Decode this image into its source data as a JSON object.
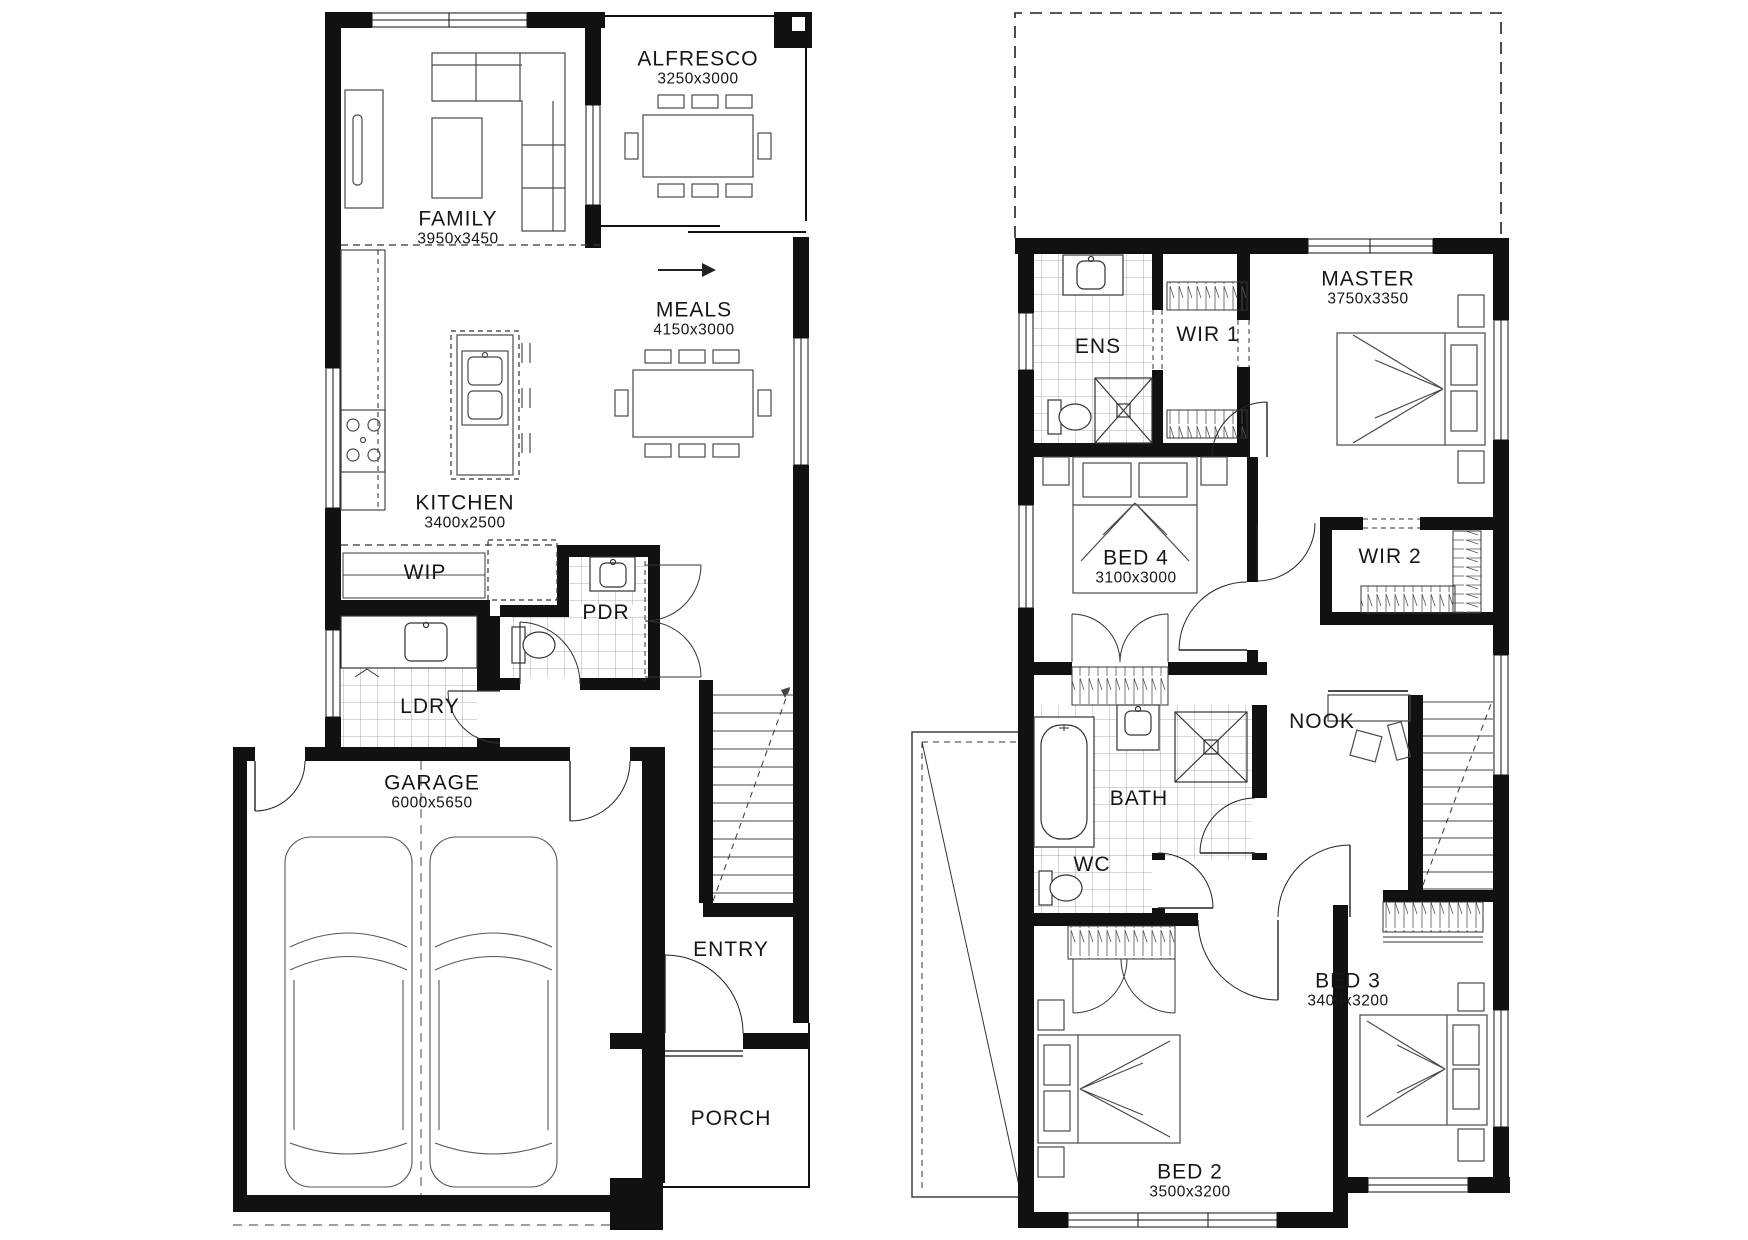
{
  "canvas": {
    "width": 1748,
    "height": 1240,
    "background": "#ffffff",
    "line_color": "#111111"
  },
  "plans": [
    {
      "name": "ground-floor",
      "rooms": [
        {
          "id": "alfresco",
          "name": "ALFRESCO",
          "dims": "3250x3000"
        },
        {
          "id": "family",
          "name": "FAMILY",
          "dims": "3950x3450"
        },
        {
          "id": "meals",
          "name": "MEALS",
          "dims": "4150x3000"
        },
        {
          "id": "kitchen",
          "name": "KITCHEN",
          "dims": "3400x2500"
        },
        {
          "id": "wip",
          "name": "WIP",
          "dims": ""
        },
        {
          "id": "pdr",
          "name": "PDR",
          "dims": ""
        },
        {
          "id": "ldry",
          "name": "LDRY",
          "dims": ""
        },
        {
          "id": "garage",
          "name": "GARAGE",
          "dims": "6000x5650"
        },
        {
          "id": "entry",
          "name": "ENTRY",
          "dims": ""
        },
        {
          "id": "porch",
          "name": "PORCH",
          "dims": ""
        }
      ]
    },
    {
      "name": "first-floor",
      "rooms": [
        {
          "id": "ens",
          "name": "ENS",
          "dims": ""
        },
        {
          "id": "wir1",
          "name": "WIR 1",
          "dims": ""
        },
        {
          "id": "master",
          "name": "MASTER",
          "dims": "3750x3350"
        },
        {
          "id": "bed4",
          "name": "BED 4",
          "dims": "3100x3000"
        },
        {
          "id": "wir2",
          "name": "WIR 2",
          "dims": ""
        },
        {
          "id": "nook",
          "name": "NOOK",
          "dims": ""
        },
        {
          "id": "bath",
          "name": "BATH",
          "dims": ""
        },
        {
          "id": "wc",
          "name": "WC",
          "dims": ""
        },
        {
          "id": "bed3",
          "name": "BED 3",
          "dims": "3400x3200"
        },
        {
          "id": "bed2",
          "name": "BED 2",
          "dims": "3500x3200"
        }
      ]
    }
  ]
}
